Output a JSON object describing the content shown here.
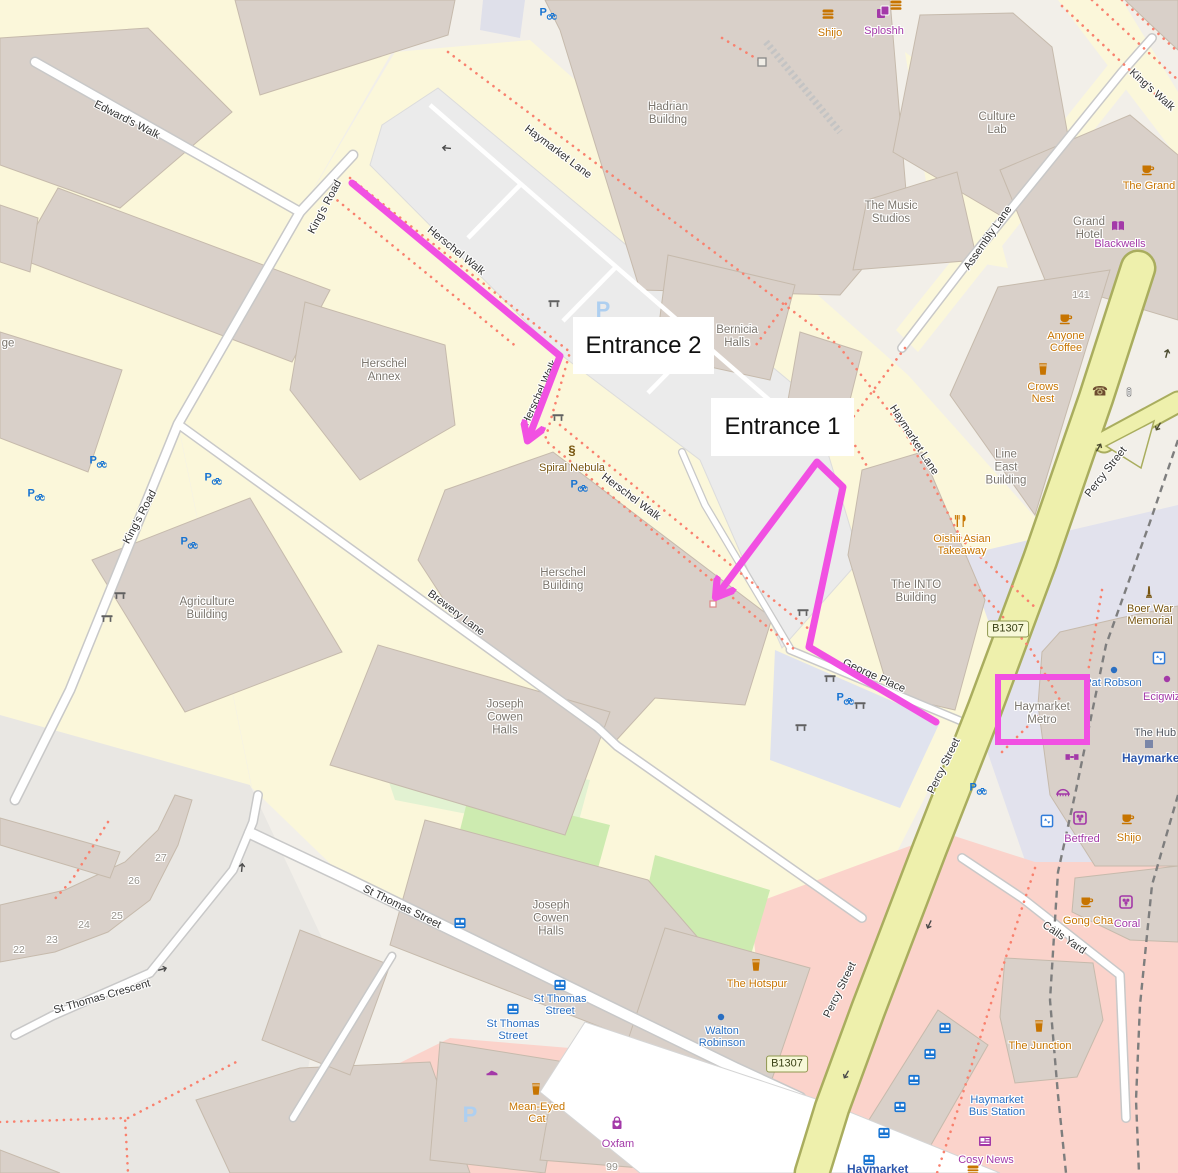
{
  "annotations": {
    "entrance1": {
      "label": "Entrance 1"
    },
    "entrance2": {
      "label": "Entrance 2"
    },
    "highlight_color": "#f150e2",
    "routes": [
      {
        "id": "route-entrance-2",
        "points": "352,183 560,356 529,437"
      },
      {
        "id": "route-entrance-1",
        "points": "936,722 809,647 843,487 817,462 718,594"
      }
    ],
    "highlight_box": {
      "id": "haymarket-metro-highlight-box",
      "x": 998,
      "y": 677,
      "w": 89,
      "h": 65
    }
  },
  "map": {
    "road_labels": [
      {
        "id": "road-label-edwards-walk",
        "t": "Edward's Walk",
        "x": 127,
        "y": 120,
        "r": 27
      },
      {
        "id": "road-label-kings-road-1",
        "t": "King's Road",
        "x": 325,
        "y": 207,
        "r": -62
      },
      {
        "id": "road-label-kings-road-2",
        "t": "King's Road",
        "x": 140,
        "y": 517,
        "r": -62
      },
      {
        "id": "road-label-kings-walk",
        "t": "King's Walk",
        "x": 1152,
        "y": 90,
        "r": 42
      },
      {
        "id": "road-label-haymarket-lane-1",
        "t": "Haymarket Lane",
        "x": 558,
        "y": 152,
        "r": 37
      },
      {
        "id": "road-label-haymarket-lane-2",
        "t": "Haymarket Lane",
        "x": 914,
        "y": 440,
        "r": 57
      },
      {
        "id": "road-label-assembly-lane",
        "t": "Assembly Lane",
        "x": 988,
        "y": 238,
        "r": -55
      },
      {
        "id": "road-label-herschel-walk-1",
        "t": "Herschel Walk",
        "x": 456,
        "y": 251,
        "r": 39
      },
      {
        "id": "road-label-herschel-walk-2",
        "t": "Herschel Walk",
        "x": 540,
        "y": 393,
        "r": -65
      },
      {
        "id": "road-label-herschel-walk-3",
        "t": "Herschel Walk",
        "x": 631,
        "y": 497,
        "r": 37
      },
      {
        "id": "road-label-brewery-lane",
        "t": "Brewery Lane",
        "x": 456,
        "y": 613,
        "r": 37
      },
      {
        "id": "road-label-george-place",
        "t": "George Place",
        "x": 874,
        "y": 676,
        "r": 24
      },
      {
        "id": "road-label-percy-street-1",
        "t": "Percy Street",
        "x": 1106,
        "y": 472,
        "r": -52
      },
      {
        "id": "road-label-percy-street-2",
        "t": "Percy Street",
        "x": 944,
        "y": 766,
        "r": -64
      },
      {
        "id": "road-label-percy-street-3",
        "t": "Percy Street",
        "x": 840,
        "y": 990,
        "r": -64
      },
      {
        "id": "road-label-st-thomas-street",
        "t": "St Thomas Street",
        "x": 402,
        "y": 907,
        "r": 26
      },
      {
        "id": "road-label-st-thomas-crescent",
        "t": "St Thomas Crescent",
        "x": 102,
        "y": 997,
        "r": -16
      },
      {
        "id": "road-label-cails-yard",
        "t": "Cails Yard",
        "x": 1064,
        "y": 938,
        "r": 34
      }
    ],
    "building_labels": [
      {
        "id": "label-hadrian-building",
        "lines": [
          "Hadrian",
          "Buildng"
        ],
        "x": 668,
        "y": 114
      },
      {
        "id": "label-culture-lab",
        "lines": [
          "Culture",
          "Lab"
        ],
        "x": 997,
        "y": 124
      },
      {
        "id": "label-music-studios",
        "lines": [
          "The Music",
          "Studios"
        ],
        "x": 891,
        "y": 213
      },
      {
        "id": "label-grand-hotel",
        "lines": [
          "Grand",
          "Hotel"
        ],
        "x": 1089,
        "y": 229
      },
      {
        "id": "label-herschel-annex",
        "lines": [
          "Herschel",
          "Annex"
        ],
        "x": 384,
        "y": 371
      },
      {
        "id": "label-bernicia-halls",
        "lines": [
          "Bernicia",
          "Halls"
        ],
        "x": 737,
        "y": 337
      },
      {
        "id": "label-line-east-building",
        "lines": [
          "Line",
          "East",
          "Building"
        ],
        "x": 1006,
        "y": 468
      },
      {
        "id": "label-herschel-building",
        "lines": [
          "Herschel",
          "Building"
        ],
        "x": 563,
        "y": 580
      },
      {
        "id": "label-agriculture-building",
        "lines": [
          "Agriculture",
          "Building"
        ],
        "x": 207,
        "y": 609
      },
      {
        "id": "label-into-building",
        "lines": [
          "The INTO",
          "Building"
        ],
        "x": 916,
        "y": 592
      },
      {
        "id": "label-joseph-cowen-halls-1",
        "lines": [
          "Joseph",
          "Cowen",
          "Halls"
        ],
        "x": 505,
        "y": 718
      },
      {
        "id": "label-joseph-cowen-halls-2",
        "lines": [
          "Joseph",
          "Cowen",
          "Halls"
        ],
        "x": 551,
        "y": 919
      },
      {
        "id": "label-haymarket-metro",
        "lines": [
          "Haymarket",
          "Metro"
        ],
        "x": 1042,
        "y": 714
      },
      {
        "id": "label-left-edge-cut",
        "lines": [
          "ge"
        ],
        "x": 8,
        "y": 344
      }
    ],
    "poi_labels": [
      {
        "id": "poi-shijo-top",
        "lines": [
          "Shijo"
        ],
        "x": 830,
        "y": 33,
        "cat": "orange"
      },
      {
        "id": "poi-sploshh",
        "lines": [
          "Sploshh"
        ],
        "x": 884,
        "y": 31,
        "cat": "purple"
      },
      {
        "id": "poi-the-grand",
        "lines": [
          "The Grand"
        ],
        "x": 1149,
        "y": 186,
        "cat": "orange"
      },
      {
        "id": "poi-blackwells",
        "lines": [
          "Blackwells"
        ],
        "x": 1120,
        "y": 244,
        "cat": "purple"
      },
      {
        "id": "poi-anyone-coffee",
        "lines": [
          "Anyone",
          "Coffee"
        ],
        "x": 1066,
        "y": 342,
        "cat": "orange"
      },
      {
        "id": "poi-crows-nest",
        "lines": [
          "Crows",
          "Nest"
        ],
        "x": 1043,
        "y": 393,
        "cat": "orange"
      },
      {
        "id": "poi-spiral-nebula",
        "lines": [
          "Spiral Nebula"
        ],
        "x": 572,
        "y": 468,
        "cat": "brown"
      },
      {
        "id": "poi-oishii",
        "lines": [
          "Oishii Asian",
          "Takeaway"
        ],
        "x": 962,
        "y": 545,
        "cat": "orange"
      },
      {
        "id": "poi-boer-war-memorial",
        "lines": [
          "Boer War",
          "Memorial"
        ],
        "x": 1150,
        "y": 615,
        "cat": "brown"
      },
      {
        "id": "poi-pat-robson",
        "lines": [
          "Pat Robson"
        ],
        "x": 1113,
        "y": 683,
        "cat": "blue"
      },
      {
        "id": "poi-ecigwizard",
        "lines": [
          "Ecigwizard"
        ],
        "x": 1143,
        "y": 697,
        "cat": "purple",
        "align": "left"
      },
      {
        "id": "poi-the-hub",
        "lines": [
          "The Hub"
        ],
        "x": 1155,
        "y": 733,
        "cat": "slate"
      },
      {
        "id": "poi-haymarket-station-1",
        "lines": [
          "Haymarket"
        ],
        "x": 1122,
        "y": 758,
        "cat": "station",
        "align": "left"
      },
      {
        "id": "poi-betfred",
        "lines": [
          "Betfred"
        ],
        "x": 1082,
        "y": 839,
        "cat": "purple"
      },
      {
        "id": "poi-shijo-2",
        "lines": [
          "Shijo"
        ],
        "x": 1129,
        "y": 838,
        "cat": "orange"
      },
      {
        "id": "poi-gong-cha",
        "lines": [
          "Gong Cha"
        ],
        "x": 1088,
        "y": 921,
        "cat": "orange"
      },
      {
        "id": "poi-coral",
        "lines": [
          "Coral"
        ],
        "x": 1127,
        "y": 924,
        "cat": "purple"
      },
      {
        "id": "poi-the-hotspur",
        "lines": [
          "The Hotspur"
        ],
        "x": 757,
        "y": 984,
        "cat": "orange"
      },
      {
        "id": "poi-walton-robinson",
        "lines": [
          "Walton",
          "Robinson"
        ],
        "x": 722,
        "y": 1037,
        "cat": "blue"
      },
      {
        "id": "poi-mean-eyed-cat",
        "lines": [
          "Mean-Eyed",
          "Cat"
        ],
        "x": 537,
        "y": 1113,
        "cat": "orange"
      },
      {
        "id": "poi-oxfam",
        "lines": [
          "Oxfam"
        ],
        "x": 618,
        "y": 1144,
        "cat": "purple"
      },
      {
        "id": "poi-the-junction",
        "lines": [
          "The Junction"
        ],
        "x": 1040,
        "y": 1046,
        "cat": "orange"
      },
      {
        "id": "poi-cosy-news",
        "lines": [
          "Cosy News"
        ],
        "x": 986,
        "y": 1160,
        "cat": "purple"
      },
      {
        "id": "poi-bus-stop-st-thomas-1",
        "lines": [
          "St Thomas",
          "Street"
        ],
        "x": 560,
        "y": 1005,
        "cat": "blue"
      },
      {
        "id": "poi-bus-stop-st-thomas-2",
        "lines": [
          "St Thomas",
          "Street"
        ],
        "x": 513,
        "y": 1030,
        "cat": "blue"
      },
      {
        "id": "poi-haymarket-bus-station",
        "lines": [
          "Haymarket",
          "Bus Station"
        ],
        "x": 997,
        "y": 1106,
        "cat": "blue"
      },
      {
        "id": "poi-haymarket-station-2",
        "lines": [
          "Haymarket"
        ],
        "x": 847,
        "y": 1169,
        "cat": "station",
        "align": "left"
      }
    ],
    "house_numbers": [
      {
        "t": "141",
        "x": 1081,
        "y": 295
      },
      {
        "t": "27",
        "x": 161,
        "y": 858
      },
      {
        "t": "26",
        "x": 134,
        "y": 881
      },
      {
        "t": "25",
        "x": 117,
        "y": 916
      },
      {
        "t": "24",
        "x": 84,
        "y": 925
      },
      {
        "t": "23",
        "x": 52,
        "y": 940
      },
      {
        "t": "22",
        "x": 19,
        "y": 950
      },
      {
        "t": "99",
        "x": 612,
        "y": 1167
      }
    ],
    "badges": [
      {
        "t": "B1307",
        "x": 1008,
        "y": 629
      },
      {
        "t": "B1307",
        "x": 787,
        "y": 1064
      }
    ],
    "parking_p": [
      {
        "x": 603,
        "y": 310
      },
      {
        "x": 470,
        "y": 1115
      }
    ],
    "icons": [
      {
        "n": "burger",
        "x": 828,
        "y": 14,
        "c": "#c77400"
      },
      {
        "n": "burger",
        "x": 896,
        "y": 5,
        "c": "#c77400"
      },
      {
        "n": "copy",
        "x": 883,
        "y": 12,
        "c": "#a339a8"
      },
      {
        "n": "cup",
        "x": 1148,
        "y": 169,
        "c": "#c77400"
      },
      {
        "n": "book",
        "x": 1118,
        "y": 226,
        "c": "#a339a8"
      },
      {
        "n": "cup",
        "x": 1066,
        "y": 318,
        "c": "#c77400"
      },
      {
        "n": "pint",
        "x": 1043,
        "y": 369,
        "c": "#c77400"
      },
      {
        "n": "artwork",
        "x": 572,
        "y": 450,
        "c": "#77540e"
      },
      {
        "n": "restaurant",
        "x": 961,
        "y": 521,
        "c": "#c77400"
      },
      {
        "n": "memorial",
        "x": 1149,
        "y": 592,
        "c": "#77540e"
      },
      {
        "n": "pint",
        "x": 756,
        "y": 965,
        "c": "#c77400"
      },
      {
        "n": "pint",
        "x": 536,
        "y": 1089,
        "c": "#c77400"
      },
      {
        "n": "shoe",
        "x": 492,
        "y": 1071,
        "c": "#a339a8"
      },
      {
        "n": "bag",
        "x": 617,
        "y": 1123,
        "c": "#a339a8"
      },
      {
        "n": "cup",
        "x": 1087,
        "y": 901,
        "c": "#c77400"
      },
      {
        "n": "betting",
        "x": 1126,
        "y": 902,
        "c": "#a339a8"
      },
      {
        "n": "pint",
        "x": 1039,
        "y": 1026,
        "c": "#c77400"
      },
      {
        "n": "news",
        "x": 985,
        "y": 1141,
        "c": "#a339a8"
      },
      {
        "n": "burger",
        "x": 973,
        "y": 1170,
        "c": "#c77400"
      },
      {
        "n": "betting",
        "x": 1080,
        "y": 818,
        "c": "#a339a8"
      },
      {
        "n": "cup",
        "x": 1128,
        "y": 818,
        "c": "#c77400"
      },
      {
        "n": "metro-gate",
        "x": 1072,
        "y": 757,
        "c": "#a339a8"
      },
      {
        "n": "awning",
        "x": 1063,
        "y": 792,
        "c": "#a339a8"
      },
      {
        "n": "phone",
        "x": 1100,
        "y": 391,
        "c": "#6d4c2f"
      },
      {
        "n": "signal",
        "x": 1129,
        "y": 392,
        "c": "#555555"
      },
      {
        "n": "elevator",
        "x": 1159,
        "y": 658,
        "c": "#2f7bd9"
      },
      {
        "n": "elevator",
        "x": 1047,
        "y": 821,
        "c": "#2f7bd9"
      },
      {
        "n": "gate",
        "x": 762,
        "y": 62,
        "c": "#888888"
      },
      {
        "n": "door",
        "x": 713,
        "y": 604,
        "c": "#dd8888"
      },
      {
        "n": "dot",
        "x": 1114,
        "y": 670,
        "c": "#2a6fc2"
      },
      {
        "n": "dot",
        "x": 721,
        "y": 1017,
        "c": "#2a6fc2"
      },
      {
        "n": "dot",
        "x": 1167,
        "y": 679,
        "c": "#a339a8"
      },
      {
        "n": "square",
        "x": 1149,
        "y": 744,
        "c": "#7a86a8"
      },
      {
        "n": "bus",
        "x": 945,
        "y": 1028,
        "c": "#1673d2"
      },
      {
        "n": "bus",
        "x": 930,
        "y": 1054,
        "c": "#1673d2"
      },
      {
        "n": "bus",
        "x": 914,
        "y": 1080,
        "c": "#1673d2"
      },
      {
        "n": "bus",
        "x": 900,
        "y": 1107,
        "c": "#1673d2"
      },
      {
        "n": "bus",
        "x": 884,
        "y": 1133,
        "c": "#1673d2"
      },
      {
        "n": "bus",
        "x": 869,
        "y": 1160,
        "c": "#1673d2"
      },
      {
        "n": "bus",
        "x": 460,
        "y": 923,
        "c": "#1673d2"
      },
      {
        "n": "bus",
        "x": 560,
        "y": 985,
        "c": "#1673d2"
      },
      {
        "n": "bus",
        "x": 513,
        "y": 1009,
        "c": "#1673d2"
      },
      {
        "n": "bench",
        "x": 554,
        "y": 303,
        "c": "#606060"
      },
      {
        "n": "bench",
        "x": 558,
        "y": 417,
        "c": "#606060"
      },
      {
        "n": "bench",
        "x": 803,
        "y": 612,
        "c": "#606060"
      },
      {
        "n": "bench",
        "x": 830,
        "y": 678,
        "c": "#606060"
      },
      {
        "n": "bench",
        "x": 860,
        "y": 705,
        "c": "#606060"
      },
      {
        "n": "bench",
        "x": 801,
        "y": 727,
        "c": "#606060"
      },
      {
        "n": "bench",
        "x": 107,
        "y": 618,
        "c": "#606060"
      },
      {
        "n": "bench",
        "x": 120,
        "y": 595,
        "c": "#606060"
      },
      {
        "n": "bike",
        "x": 98,
        "y": 461,
        "c": "#1673d2"
      },
      {
        "n": "bike",
        "x": 213,
        "y": 478,
        "c": "#1673d2"
      },
      {
        "n": "bike",
        "x": 189,
        "y": 542,
        "c": "#1673d2"
      },
      {
        "n": "bike",
        "x": 36,
        "y": 494,
        "c": "#1673d2"
      },
      {
        "n": "bike",
        "x": 579,
        "y": 485,
        "c": "#1673d2"
      },
      {
        "n": "bike",
        "x": 845,
        "y": 698,
        "c": "#1673d2"
      },
      {
        "n": "bike",
        "x": 978,
        "y": 788,
        "c": "#1673d2"
      },
      {
        "n": "bike",
        "x": 548,
        "y": 13,
        "c": "#1673d2"
      },
      {
        "n": "oneway",
        "x": 446,
        "y": 148,
        "c": "#4a4a4a",
        "r": 185
      },
      {
        "n": "oneway",
        "x": 163,
        "y": 969,
        "c": "#4a4a4a",
        "r": -15
      },
      {
        "n": "oneway",
        "x": 242,
        "y": 867,
        "c": "#4a4a4a",
        "r": -85
      },
      {
        "n": "oneway",
        "x": 1167,
        "y": 353,
        "c": "#4a4a2e",
        "r": -75
      },
      {
        "n": "oneway",
        "x": 1158,
        "y": 427,
        "c": "#4a4a2e",
        "r": 120
      },
      {
        "n": "oneway",
        "x": 1099,
        "y": 447,
        "c": "#4a4a2e",
        "r": -60
      },
      {
        "n": "oneway",
        "x": 929,
        "y": 925,
        "c": "#4a4a4a",
        "r": 115
      },
      {
        "n": "oneway",
        "x": 846,
        "y": 1075,
        "c": "#4a4a4a",
        "r": 120
      }
    ]
  }
}
